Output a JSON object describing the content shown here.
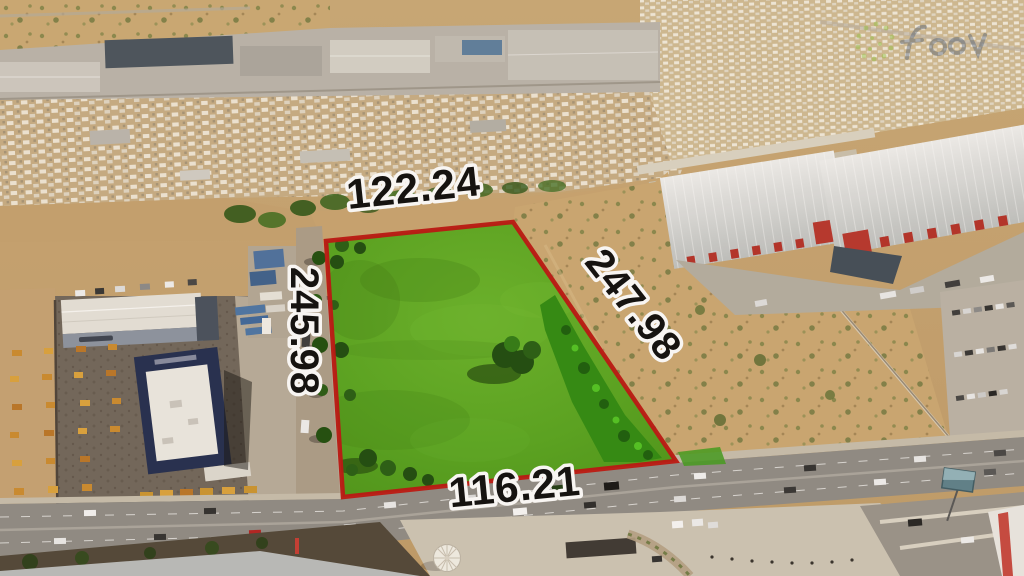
{
  "annotations": {
    "side_top": "122.24",
    "side_left": "245.98",
    "side_right": "247.98",
    "side_bottom": "116.21"
  },
  "colors": {
    "parcel_fill": "#55a21e",
    "parcel_outline": "#b81410",
    "label_fill": "#0c0c0c",
    "label_outline": "#fafafa",
    "desert": "#c9a671",
    "road": "#8d8a84"
  }
}
